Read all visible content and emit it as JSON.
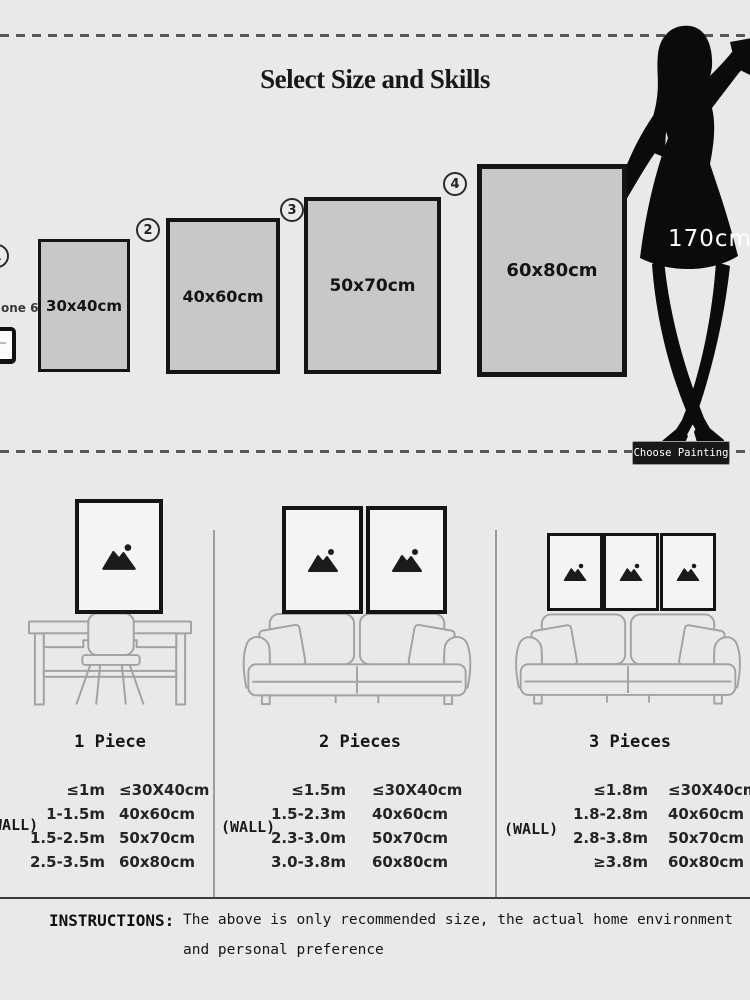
{
  "header": {
    "title": "Select Size and Skills",
    "model_height": "170cm",
    "choose_button_label": "Choose Painting",
    "phone_label": "one 6"
  },
  "size_options": [
    {
      "marker": "1",
      "size": "30x40cm"
    },
    {
      "marker": "2",
      "size": "40x60cm"
    },
    {
      "marker": "3",
      "size": "50x70cm"
    },
    {
      "marker": "4",
      "size": "60x80cm"
    }
  ],
  "scenes": [
    {
      "label": "1 Piece",
      "wall": "(WALL)",
      "rows": [
        [
          "≤1m",
          "≤30X40cm"
        ],
        [
          "1-1.5m",
          "40x60cm"
        ],
        [
          "1.5-2.5m",
          "50x70cm"
        ],
        [
          "2.5-3.5m",
          "60x80cm"
        ]
      ]
    },
    {
      "label": "2 Pieces",
      "wall": "(WALL)",
      "rows": [
        [
          "≤1.5m",
          "≤30X40cm"
        ],
        [
          "1.5-2.3m",
          "40x60cm"
        ],
        [
          "2.3-3.0m",
          "50x70cm"
        ],
        [
          "3.0-3.8m",
          "60x80cm"
        ]
      ]
    },
    {
      "label": "3 Pieces",
      "wall": "(WALL)",
      "rows": [
        [
          "≤1.8m",
          "≤30X40cm"
        ],
        [
          "1.8-2.8m",
          "40x60cm"
        ],
        [
          "2.8-3.8m",
          "50x70cm"
        ],
        [
          "≥3.8m",
          "60x80cm"
        ]
      ]
    }
  ],
  "instructions": {
    "heading": "INSTRUCTIONS:",
    "line1": "The above is only recommended size, the actual home environment",
    "line2": "and personal preference"
  },
  "colors": {
    "background": "#e9e9e9",
    "frame_fill": "#c8c8c8",
    "frame_border": "#151515",
    "silhouette": "#0b0b0b",
    "line_art": "#a2a2a2",
    "button_bg": "#181818",
    "button_text": "#ffffff"
  }
}
